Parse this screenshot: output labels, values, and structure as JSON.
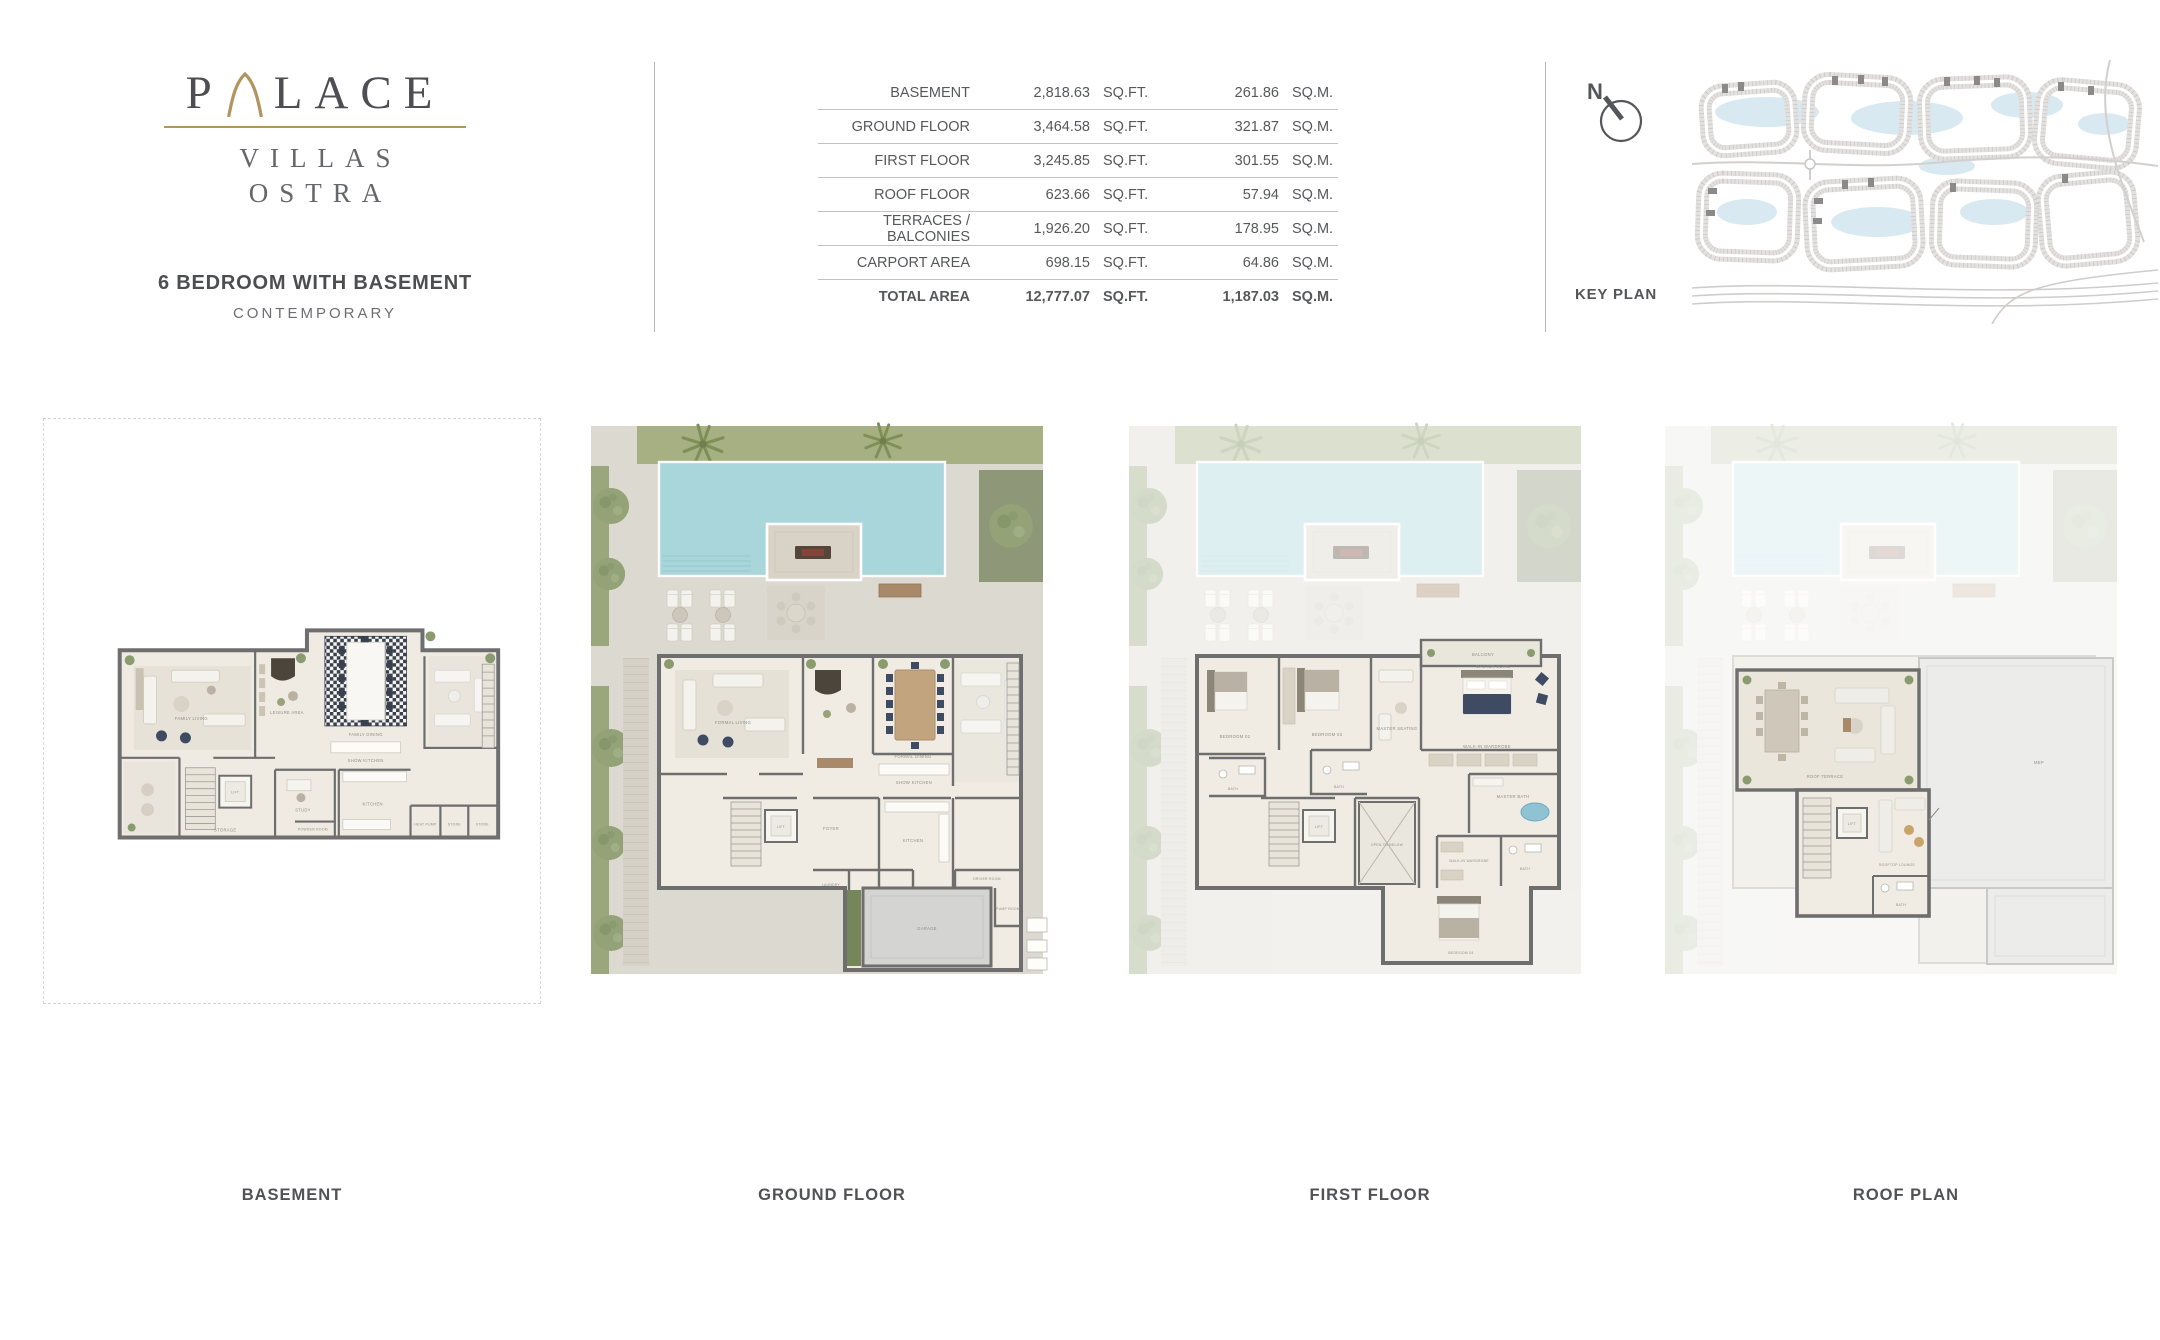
{
  "logo": {
    "p": "P",
    "lace": "LACE",
    "villas": "VILLAS",
    "ostra": "OSTRA"
  },
  "header": {
    "unit_type": "6 BEDROOM WITH BASEMENT",
    "style": "CONTEMPORARY"
  },
  "area_table": {
    "sqft_unit": "SQ.FT.",
    "sqm_unit": "SQ.M.",
    "rows": [
      {
        "label": "BASEMENT",
        "sqft": "2,818.63",
        "sqm": "261.86"
      },
      {
        "label": "GROUND FLOOR",
        "sqft": "3,464.58",
        "sqm": "321.87"
      },
      {
        "label": "FIRST FLOOR",
        "sqft": "3,245.85",
        "sqm": "301.55"
      },
      {
        "label": "ROOF FLOOR",
        "sqft": "623.66",
        "sqm": "57.94"
      },
      {
        "label": "TERRACES / BALCONIES",
        "sqft": "1,926.20",
        "sqm": "178.95"
      },
      {
        "label": "CARPORT AREA",
        "sqft": "698.15",
        "sqm": "64.86"
      },
      {
        "label": "TOTAL AREA",
        "sqft": "12,777.07",
        "sqm": "1,187.03"
      }
    ]
  },
  "key_plan": {
    "label": "KEY PLAN",
    "compass_n": "N"
  },
  "plans": [
    {
      "label": "BASEMENT",
      "rooms": {
        "family_living": "FAMILY LIVING",
        "leisure": "LEISURE AREA",
        "family_dining": "FAMILY DINING",
        "show_kitchen": "SHOW KITCHEN",
        "kitchen": "KITCHEN",
        "study": "STUDY",
        "powder_room": "POWDER ROOM",
        "storage": "STORAGE",
        "lift": "LIFT",
        "heat_pump": "HEAT PUMP",
        "store_1": "STORE",
        "store_2": "STORE"
      }
    },
    {
      "label": "GROUND FLOOR",
      "rooms": {
        "formal_living": "FORMAL LIVING",
        "formal_dining": "FORMAL DINING",
        "show_kitchen": "SHOW KITCHEN",
        "kitchen": "KITCHEN",
        "foyer": "FOYER",
        "lift": "LIFT",
        "laundry": "LAUNDRY",
        "maid_room": "MAID ROOM",
        "driver_room": "DRIVER ROOM",
        "pump_room": "PUMP ROOM",
        "garage": "GARAGE"
      }
    },
    {
      "label": "FIRST FLOOR",
      "rooms": {
        "balcony": "BALCONY",
        "master_suite": "MASTER SUITE",
        "master_seating": "MASTER SEATING",
        "walk_in_wardrobe": "WALK-IN WARDROBE",
        "master_bath": "MASTER BATH",
        "bedroom_02": "BEDROOM 02",
        "bedroom_03": "BEDROOM 03",
        "bath_1": "BATH",
        "bath_2": "BATH",
        "lift": "LIFT",
        "open_to_below": "OPEN TO BELOW",
        "walk_in_wardrobe_2": "WALK-IN WARDROBE",
        "bath_3": "BATH",
        "bedroom_04": "BEDROOM 04"
      }
    },
    {
      "label": "ROOF PLAN",
      "rooms": {
        "roof_terrace": "ROOF TERRACE",
        "rooftop_lounge": "ROOFTOP LOUNGE",
        "lift": "LIFT",
        "bath": "BATH",
        "mep": "MEP"
      }
    }
  ],
  "colors": {
    "gold": "#b3945f",
    "text_dark": "#4e4e52",
    "pool": "#a9d6db",
    "lawn": "#a6b083",
    "wall": "#6e6e6e",
    "floor": "#efebe2",
    "paving": "#dcd9d0",
    "water": "#d9e9f1",
    "highlight_plot": "#8a8a8a",
    "navy": "#3f4a63"
  }
}
